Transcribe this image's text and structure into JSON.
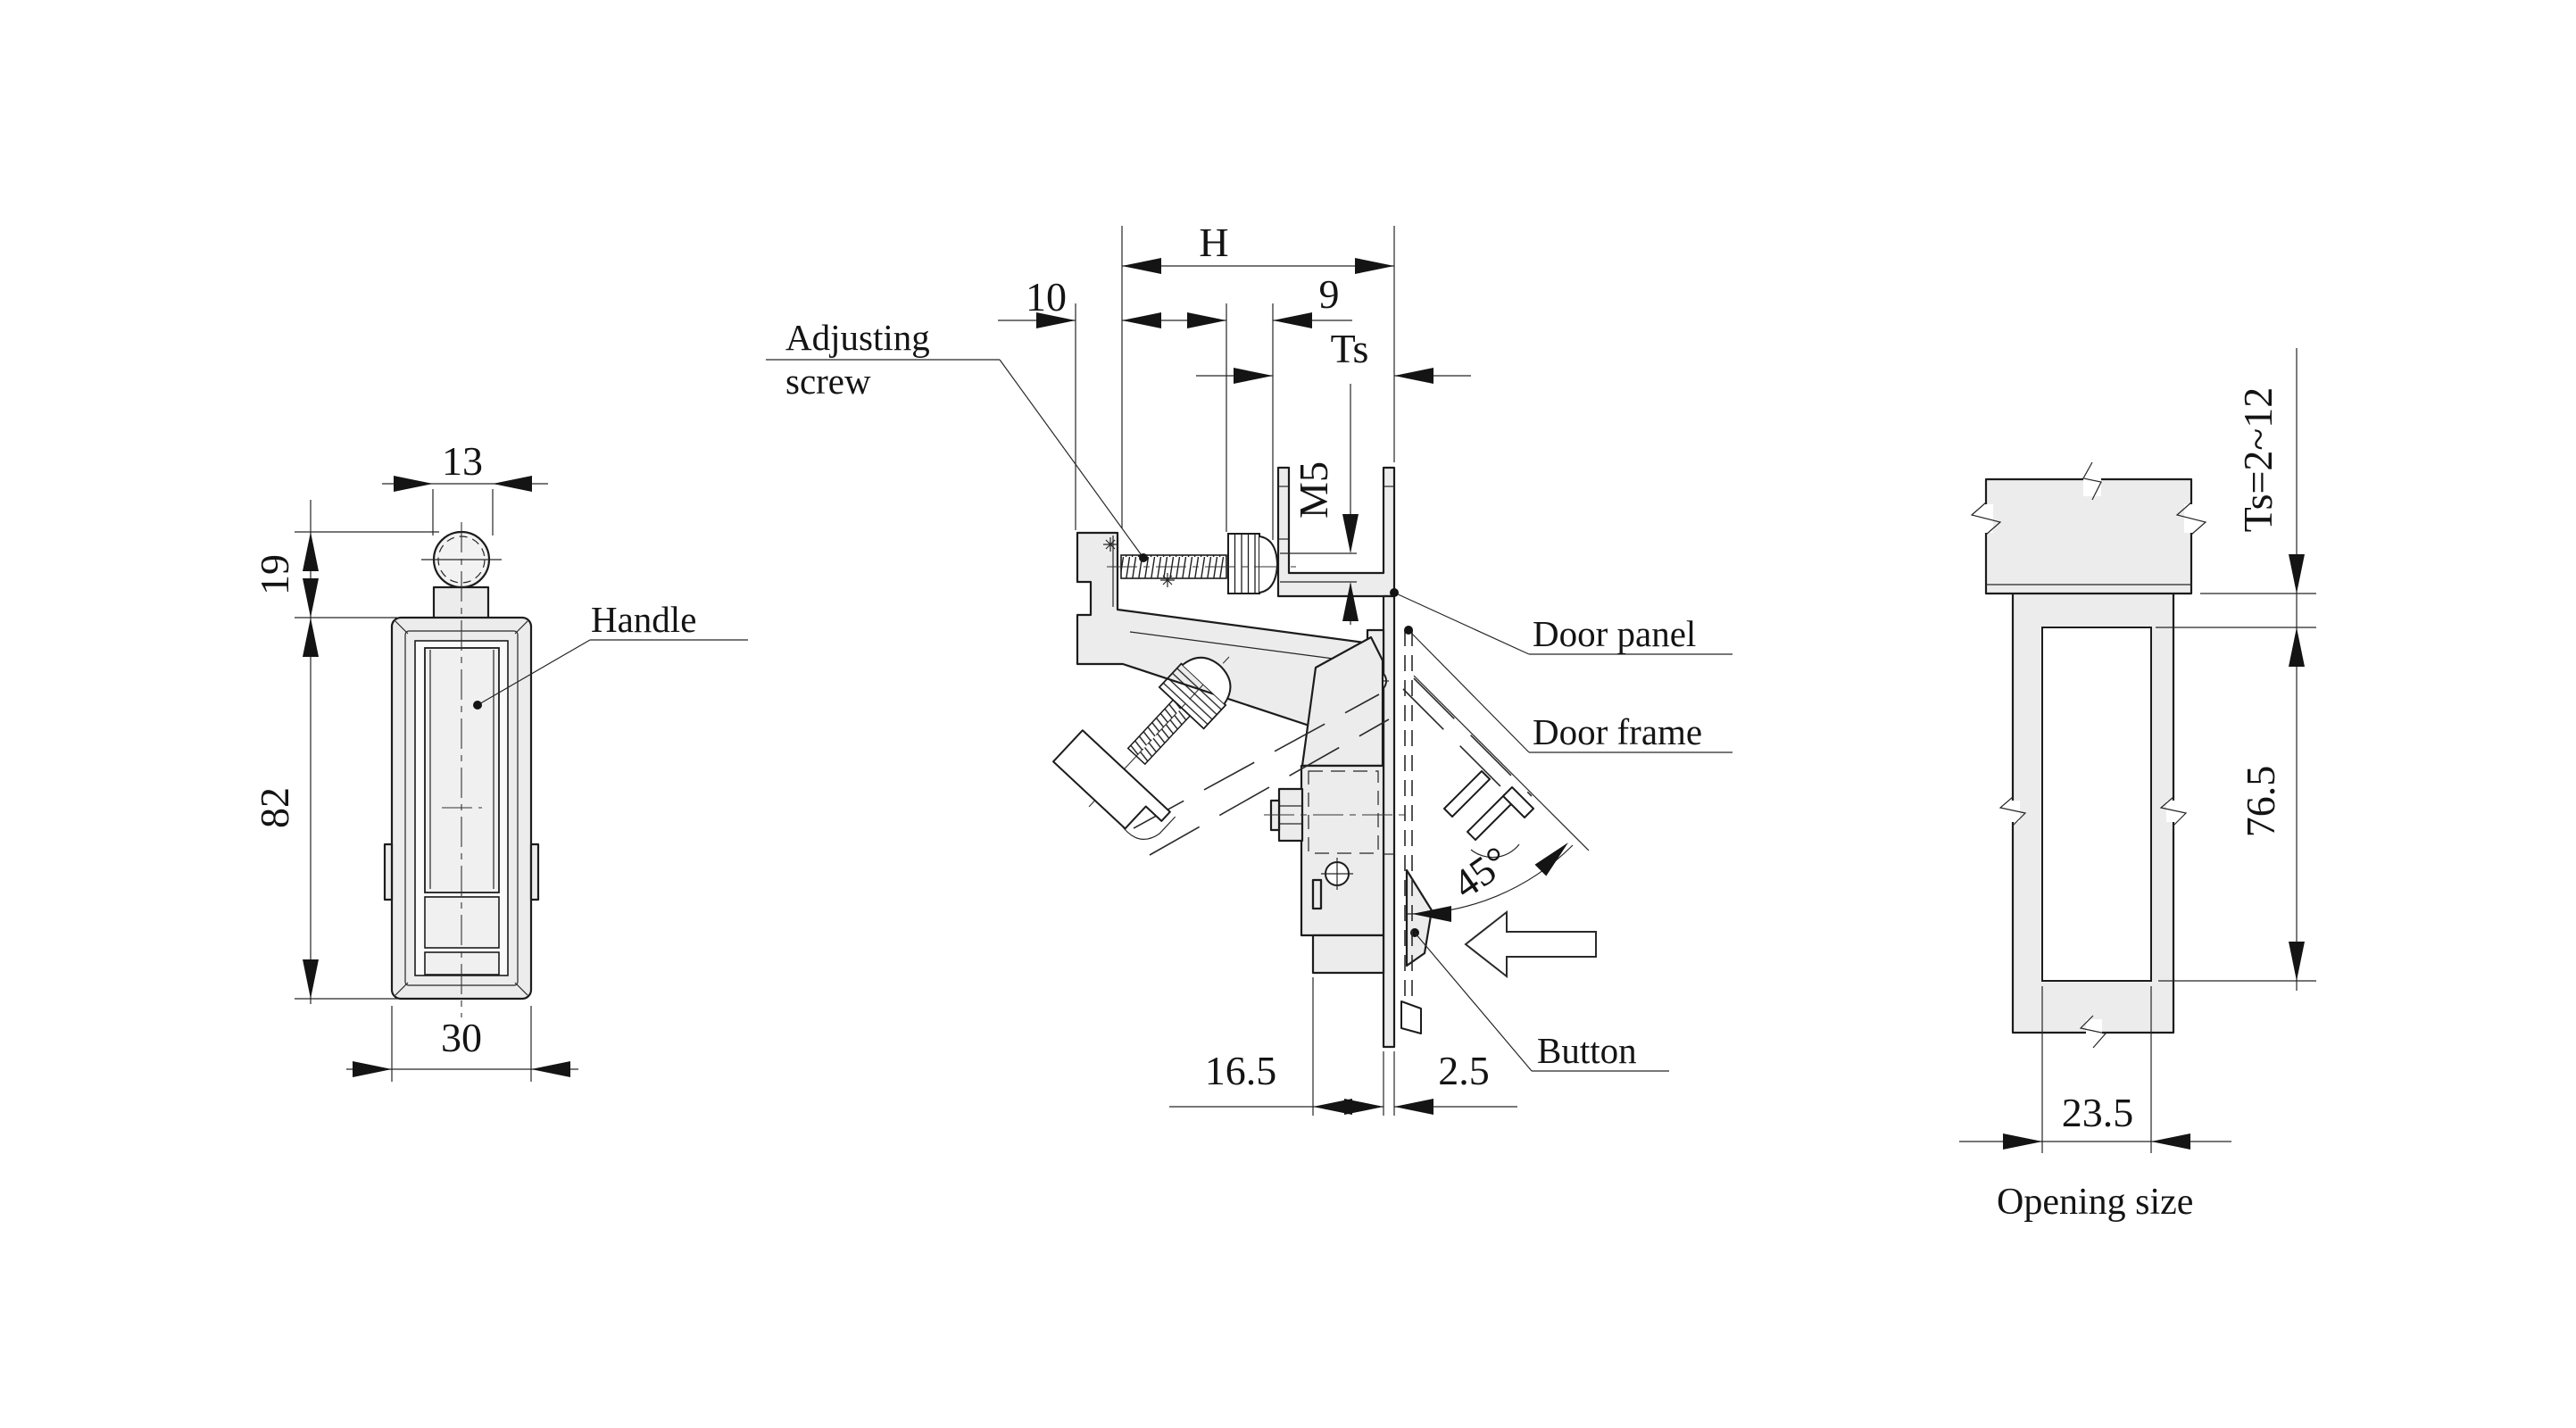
{
  "drawing": {
    "front_view": {
      "dim_knob_width": "13",
      "dim_knob_height": "19",
      "dim_body_height": "82",
      "dim_body_width": "30",
      "handle_label": "Handle"
    },
    "side_view": {
      "dim_hook": "H",
      "dim_travel": "10",
      "dim_knob": "9",
      "dim_panel_thickness": "Ts",
      "thread_size": "M5",
      "open_angle": "45°",
      "dim_depth": "16.5",
      "dim_gap": "2.5",
      "adjusting_screw_line1": "Adjusting",
      "adjusting_screw_line2": "screw",
      "door_panel_label": "Door panel",
      "door_frame_label": "Door frame",
      "button_label": "Button"
    },
    "opening_view": {
      "panel_range": "Ts=2~12",
      "dim_opening_height": "76.5",
      "dim_opening_width": "23.5",
      "caption": "Opening size"
    }
  }
}
